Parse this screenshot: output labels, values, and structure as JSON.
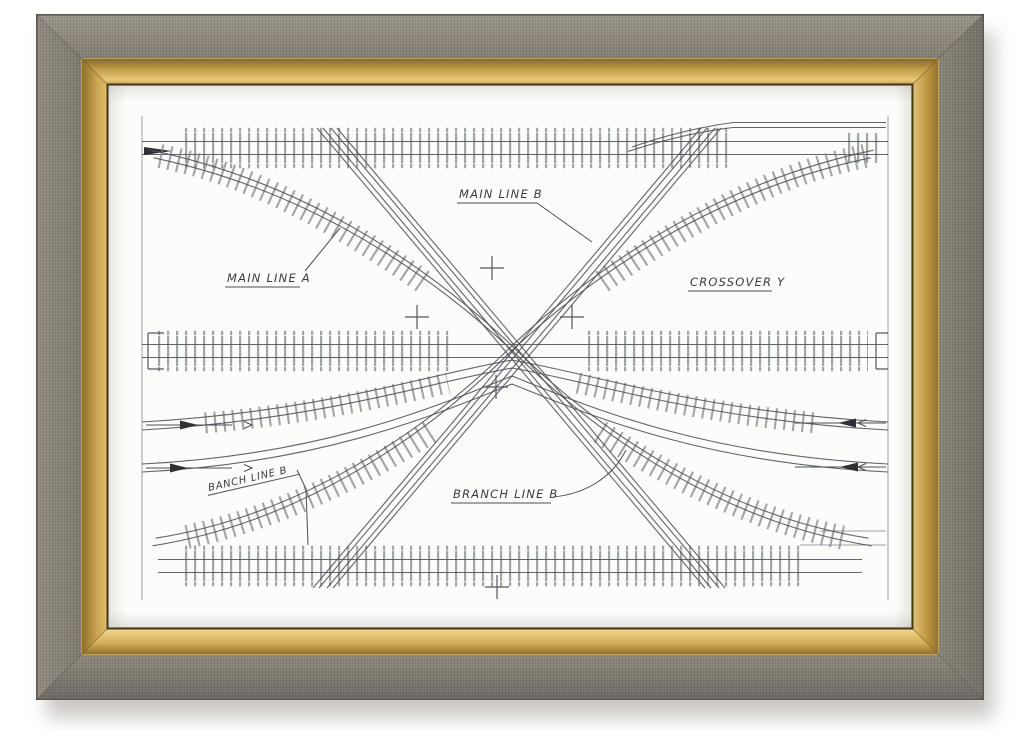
{
  "artwork": {
    "description": "Framed hand-drawn technical plan of a railway scissors crossover junction",
    "labels": {
      "main_line_a": "MAIN LINE A",
      "main_line_b": "MAIN LINE B",
      "crossover_y": "CROSSOVER Y",
      "branch_line_b_small": "BANCH LINE B",
      "branch_line_b": "BRANCH LINE B"
    }
  },
  "icons": {
    "direction_arrow_right": "▶",
    "direction_arrow_left": "◀",
    "registration_mark": "+"
  },
  "colors": {
    "background": "#ffffff",
    "frame_grey": "#87816f",
    "frame_gold": "#c4a04c",
    "paper": "#fcfcfa",
    "ink": "#4f545a"
  }
}
